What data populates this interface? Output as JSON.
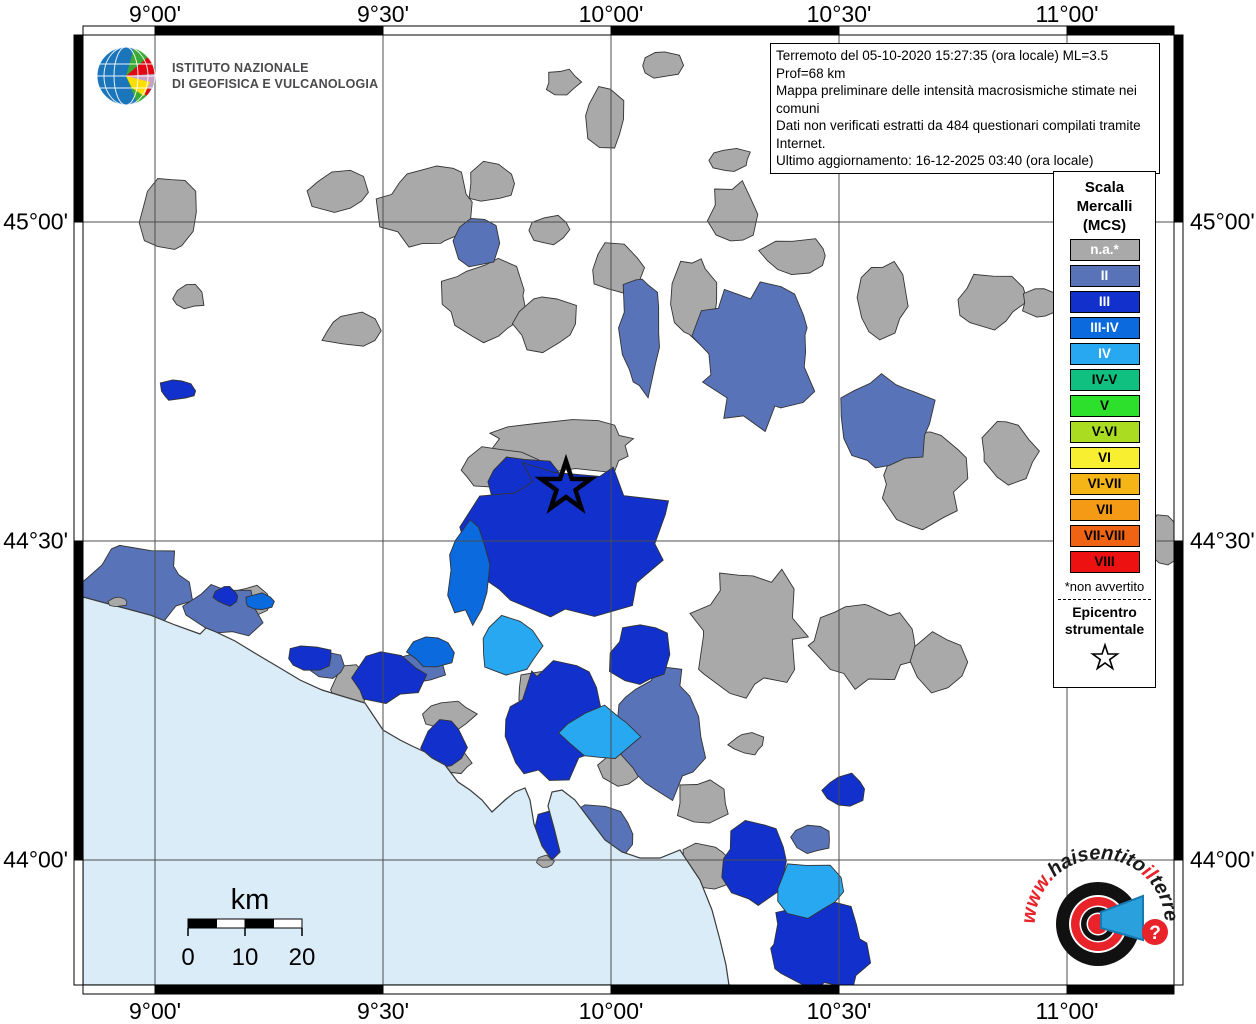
{
  "info_box": {
    "lines": [
      "Terremoto del 05-10-2020 15:27:35 (ora locale) ML=3.5 Prof=68 km",
      "Mappa preliminare delle intensità macrosismiche stimate nei comuni",
      "Dati non verificati estratti da 484 questionari compilati tramite Internet.",
      "Ultimo aggiornamento: 16-12-2025 03:40 (ora locale)"
    ]
  },
  "ingv_logo": {
    "line1": "ISTITUTO NAZIONALE",
    "line2": "DI GEOFISICA E VULCANOLOGIA"
  },
  "legend": {
    "title_lines": [
      "Scala",
      "Mercalli",
      "(MCS)"
    ],
    "items": [
      {
        "label": "n.a.*",
        "color": "#a9a9a9",
        "text": "#ffffff"
      },
      {
        "label": "II",
        "color": "#5873b8",
        "text": "#ffffff"
      },
      {
        "label": "III",
        "color": "#1130cc",
        "text": "#ffffff"
      },
      {
        "label": "III-IV",
        "color": "#0a6ade",
        "text": "#ffffff"
      },
      {
        "label": "IV",
        "color": "#29a8f2",
        "text": "#ffffff"
      },
      {
        "label": "IV-V",
        "color": "#0fc080",
        "text": "#000000"
      },
      {
        "label": "V",
        "color": "#2ce02c",
        "text": "#000000"
      },
      {
        "label": "V-VI",
        "color": "#aadd22",
        "text": "#000000"
      },
      {
        "label": "VI",
        "color": "#f7ef2f",
        "text": "#000000"
      },
      {
        "label": "VI-VII",
        "color": "#f6b517",
        "text": "#000000"
      },
      {
        "label": "VII",
        "color": "#f59a15",
        "text": "#000000"
      },
      {
        "label": "VII-VIII",
        "color": "#ef6312",
        "text": "#000000"
      },
      {
        "label": "VIII",
        "color": "#ee1111",
        "text": "#000000"
      }
    ],
    "footnote": "*non avvertito",
    "epicenter_label_lines": [
      "Epicentro",
      "strumentale"
    ]
  },
  "axes": {
    "lon_labels": [
      "9°00'",
      "9°30'",
      "10°00'",
      "10°30'",
      "11°00'"
    ],
    "lat_labels": [
      "45°00'",
      "44°30'",
      "44°00'"
    ]
  },
  "scale_bar": {
    "unit": "km",
    "tick_labels": [
      "0",
      "10",
      "20"
    ]
  },
  "footer_logo": {
    "url_text": "www.haisentitoilterremoto.it",
    "segments": [
      {
        "t": "www.",
        "c": "#e8232a"
      },
      {
        "t": "haisentito",
        "c": "#1a1a1a"
      },
      {
        "t": "il",
        "c": "#e8232a"
      },
      {
        "t": "terremoto",
        "c": "#1a1a1a"
      },
      {
        "t": ".it",
        "c": "#e8232a"
      }
    ],
    "question_mark": "?"
  },
  "map": {
    "sea_color": "#d9ecf8",
    "land_color": "#ffffff",
    "grid_color": "#4d4d4d",
    "border_color": "#3a3a3a",
    "epicenter": {
      "x": 566,
      "y": 487
    },
    "intensity_colors": {
      "na": "#a9a9a9",
      "II": "#5873b8",
      "III": "#1130cc",
      "III-IV": "#0a6ade",
      "IV": "#29a8f2"
    },
    "gridlines_x": [
      155,
      383,
      611,
      839,
      1067
    ],
    "gridlines_y": [
      222,
      541,
      860
    ],
    "regions": [
      [
        168,
        212,
        28,
        38,
        11,
        "na"
      ],
      [
        190,
        297,
        15,
        12,
        12,
        "na"
      ],
      [
        340,
        192,
        30,
        22,
        13,
        "na"
      ],
      [
        352,
        331,
        30,
        17,
        14,
        "na"
      ],
      [
        428,
        205,
        46,
        42,
        15,
        "na"
      ],
      [
        492,
        183,
        26,
        20,
        16,
        "na"
      ],
      [
        605,
        118,
        21,
        30,
        17,
        "na"
      ],
      [
        549,
        230,
        20,
        15,
        18,
        "na"
      ],
      [
        484,
        300,
        42,
        38,
        19,
        "na"
      ],
      [
        545,
        322,
        32,
        27,
        20,
        "na"
      ],
      [
        618,
        268,
        27,
        24,
        21,
        "na"
      ],
      [
        695,
        300,
        24,
        44,
        22,
        "na"
      ],
      [
        562,
        448,
        76,
        26,
        23,
        "na"
      ],
      [
        500,
        468,
        40,
        20,
        24,
        "na"
      ],
      [
        660,
        65,
        21,
        14,
        25,
        "na"
      ],
      [
        563,
        82,
        17,
        13,
        26,
        "na"
      ],
      [
        730,
        160,
        21,
        13,
        27,
        "na"
      ],
      [
        733,
        215,
        23,
        31,
        28,
        "na"
      ],
      [
        795,
        257,
        35,
        19,
        29,
        "na"
      ],
      [
        882,
        302,
        23,
        39,
        30,
        "na"
      ],
      [
        990,
        300,
        33,
        26,
        31,
        "na"
      ],
      [
        1040,
        302,
        18,
        15,
        32,
        "na"
      ],
      [
        922,
        478,
        42,
        44,
        33,
        "na"
      ],
      [
        1008,
        450,
        28,
        32,
        34,
        "na"
      ],
      [
        862,
        642,
        52,
        42,
        35,
        "na"
      ],
      [
        748,
        628,
        52,
        60,
        36,
        "na"
      ],
      [
        938,
        662,
        25,
        27,
        37,
        "na"
      ],
      [
        1164,
        542,
        19,
        25,
        38,
        "na"
      ],
      [
        450,
        716,
        25,
        15,
        39,
        "na"
      ],
      [
        547,
        692,
        32,
        22,
        40,
        "na"
      ],
      [
        252,
        601,
        19,
        15,
        41,
        "na"
      ],
      [
        350,
        688,
        17,
        24,
        42,
        "na"
      ],
      [
        747,
        744,
        17,
        11,
        43,
        "na"
      ],
      [
        702,
        802,
        27,
        22,
        44,
        "na"
      ],
      [
        622,
        766,
        21,
        19,
        45,
        "na"
      ],
      [
        706,
        868,
        25,
        25,
        46,
        "na"
      ],
      [
        660,
        916,
        17,
        12,
        47,
        "na"
      ],
      [
        455,
        762,
        17,
        11,
        48,
        "na"
      ],
      [
        476,
        243,
        22,
        26,
        61,
        "II"
      ],
      [
        641,
        330,
        20,
        60,
        62,
        "II"
      ],
      [
        757,
        356,
        58,
        66,
        63,
        "II"
      ],
      [
        886,
        420,
        45,
        43,
        64,
        "II"
      ],
      [
        138,
        586,
        54,
        37,
        65,
        "II"
      ],
      [
        225,
        612,
        38,
        25,
        66,
        "II"
      ],
      [
        325,
        664,
        20,
        14,
        67,
        "II"
      ],
      [
        421,
        666,
        24,
        15,
        68,
        "II"
      ],
      [
        662,
        732,
        42,
        60,
        69,
        "II"
      ],
      [
        600,
        832,
        36,
        30,
        70,
        "II"
      ],
      [
        812,
        839,
        20,
        14,
        71,
        "II"
      ],
      [
        178,
        390,
        19,
        10,
        81,
        "III"
      ],
      [
        528,
        482,
        36,
        26,
        82,
        "III"
      ],
      [
        566,
        540,
        98,
        70,
        83,
        "III"
      ],
      [
        640,
        655,
        29,
        32,
        84,
        "III"
      ],
      [
        555,
        722,
        46,
        54,
        85,
        "III"
      ],
      [
        385,
        678,
        36,
        23,
        86,
        "III"
      ],
      [
        310,
        658,
        22,
        13,
        87,
        "III"
      ],
      [
        445,
        745,
        21,
        25,
        88,
        "III"
      ],
      [
        560,
        840,
        32,
        27,
        89,
        "III"
      ],
      [
        227,
        597,
        12,
        9,
        90,
        "III"
      ],
      [
        755,
        862,
        30,
        39,
        92,
        "III"
      ],
      [
        818,
        946,
        50,
        44,
        93,
        "III"
      ],
      [
        845,
        790,
        23,
        15,
        94,
        "III"
      ],
      [
        468,
        570,
        20,
        48,
        101,
        "III-IV"
      ],
      [
        432,
        652,
        22,
        14,
        102,
        "III-IV"
      ],
      [
        258,
        602,
        14,
        9,
        103,
        "III-IV"
      ],
      [
        600,
        733,
        37,
        25,
        111,
        "IV"
      ],
      [
        510,
        645,
        31,
        26,
        112,
        "IV"
      ],
      [
        808,
        890,
        33,
        26,
        113,
        "IV"
      ]
    ],
    "islets": [
      [
        118,
        602,
        9,
        5,
        201
      ],
      [
        545,
        862,
        8,
        6,
        202
      ]
    ],
    "coast": [
      [
        83,
        597
      ],
      [
        120,
        607
      ],
      [
        150,
        615
      ],
      [
        175,
        625
      ],
      [
        200,
        634
      ],
      [
        206,
        628
      ],
      [
        216,
        632
      ],
      [
        235,
        641
      ],
      [
        258,
        655
      ],
      [
        280,
        668
      ],
      [
        300,
        680
      ],
      [
        322,
        690
      ],
      [
        345,
        697
      ],
      [
        365,
        703
      ],
      [
        383,
        730
      ],
      [
        400,
        740
      ],
      [
        412,
        746
      ],
      [
        425,
        752
      ],
      [
        432,
        758
      ],
      [
        445,
        765
      ],
      [
        458,
        782
      ],
      [
        470,
        790
      ],
      [
        482,
        800
      ],
      [
        492,
        812
      ],
      [
        505,
        800
      ],
      [
        515,
        792
      ],
      [
        525,
        788
      ],
      [
        530,
        800
      ],
      [
        534,
        824
      ],
      [
        542,
        846
      ],
      [
        552,
        860
      ],
      [
        560,
        852
      ],
      [
        554,
        828
      ],
      [
        548,
        806
      ],
      [
        552,
        792
      ],
      [
        562,
        790
      ],
      [
        575,
        800
      ],
      [
        590,
        820
      ],
      [
        605,
        840
      ],
      [
        622,
        852
      ],
      [
        640,
        858
      ],
      [
        660,
        858
      ],
      [
        680,
        850
      ],
      [
        700,
        880
      ],
      [
        712,
        910
      ],
      [
        720,
        940
      ],
      [
        726,
        965
      ],
      [
        730,
        992
      ]
    ]
  }
}
